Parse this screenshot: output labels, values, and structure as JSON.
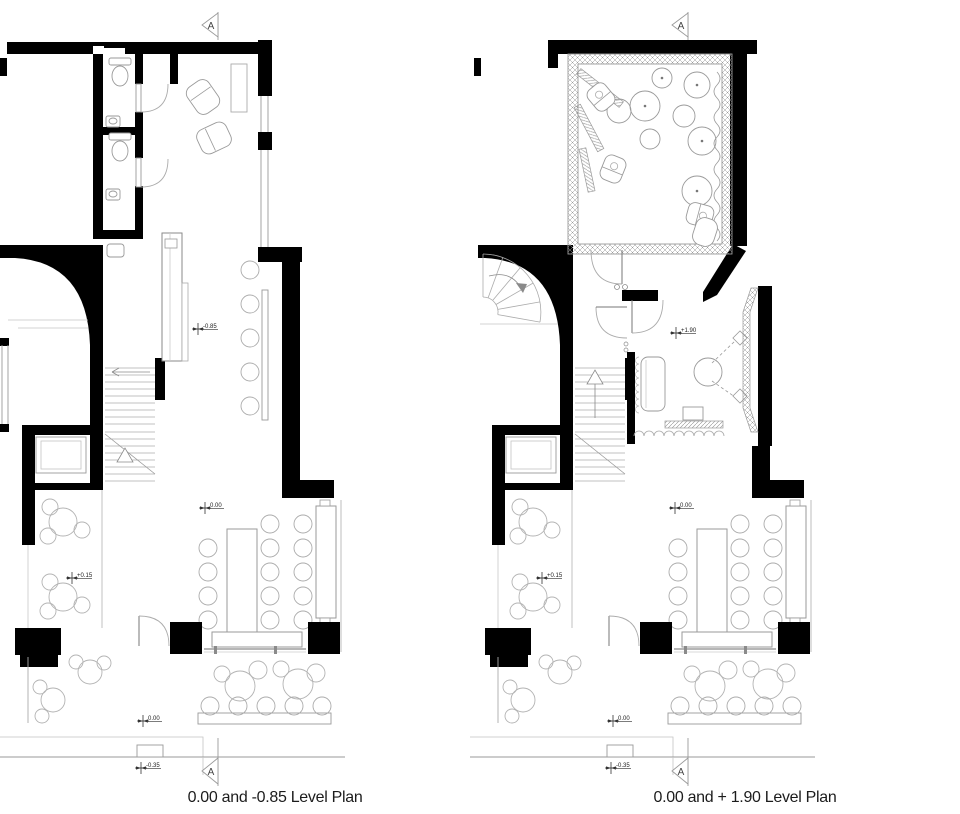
{
  "document": {
    "type": "architectural-floor-plan-sheet",
    "background": "#ffffff"
  },
  "colors": {
    "wall": "#000000",
    "furniture_line": "#a8a8a8",
    "light_line": "#c4c4c4",
    "text": "#1c1c1c"
  },
  "plans": {
    "left": {
      "caption": "0.00 and -0.85 Level Plan",
      "section_marker": "A",
      "levels": {
        "upper": "-0.85",
        "main": "0.00",
        "terrace": "+0.15",
        "outdoor": "0.00",
        "street": "-0.35"
      }
    },
    "right": {
      "caption": "0.00 and + 1.90 Level Plan",
      "section_marker": "A",
      "levels": {
        "upper": "+1.90",
        "main": "0.00",
        "terrace": "+0.15",
        "outdoor": "0.00",
        "street": "-0.35"
      }
    }
  }
}
